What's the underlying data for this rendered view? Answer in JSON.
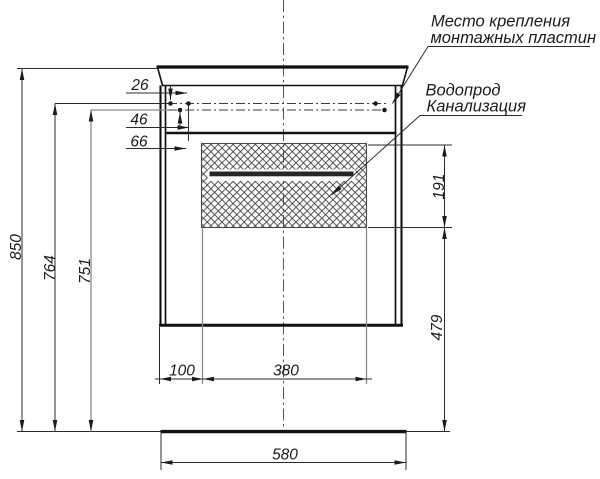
{
  "drawing": {
    "callout_mounting": {
      "line1": "Место крепления",
      "line2": "монтажных пластин"
    },
    "callout_plumbing": {
      "line1": "Водопрод",
      "line2": "Канализация"
    },
    "dims": {
      "d26": "26",
      "d46": "46",
      "d66": "66",
      "d850": "850",
      "d764": "764",
      "d751": "751",
      "d191": "191",
      "d479": "479",
      "d100": "100",
      "d380": "380",
      "d580": "580"
    }
  }
}
